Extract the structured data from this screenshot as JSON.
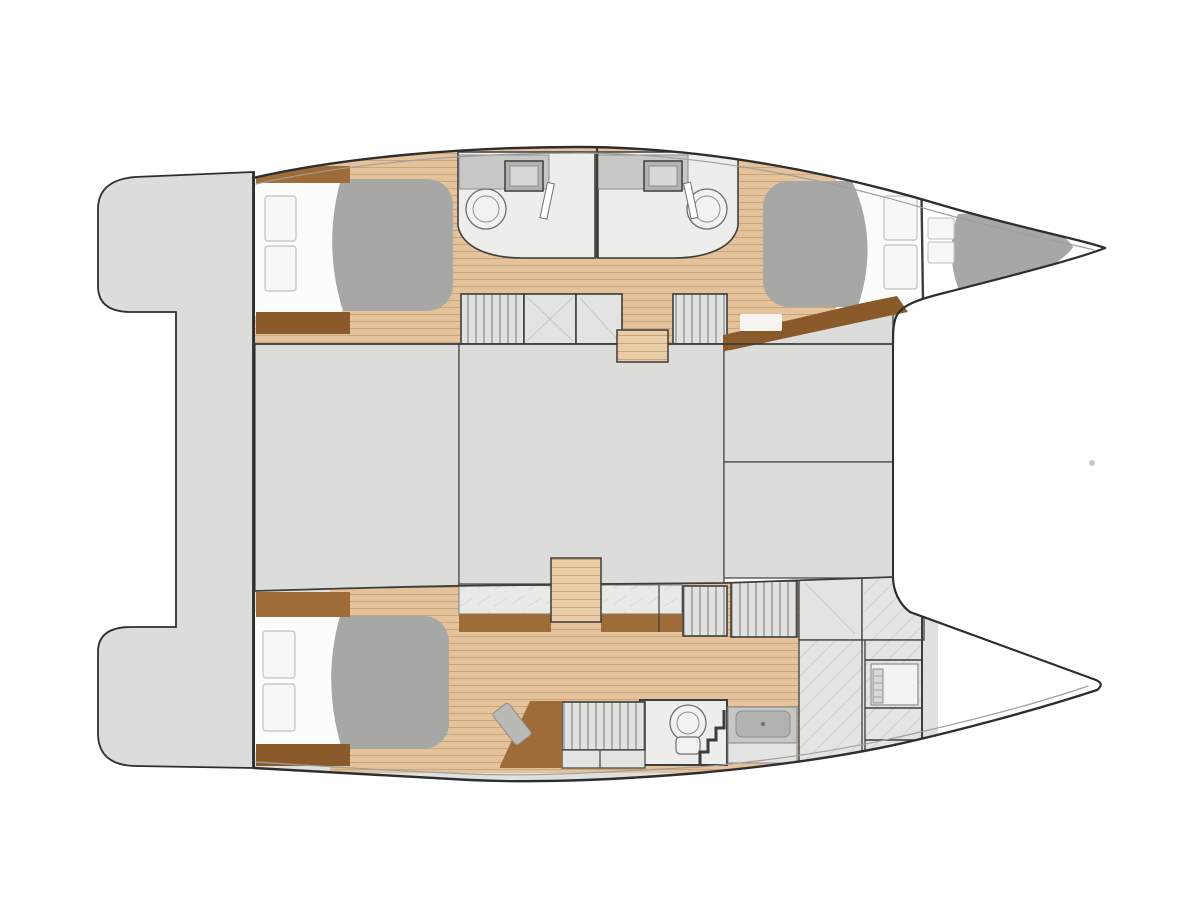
{
  "colors": {
    "background": "#ffffff",
    "outline": "#2e2e2e",
    "wall": "#3d3d3d",
    "rim": "#9f9f9f",
    "platform": "#dcdcdb",
    "hull": "#e0e0df",
    "bridge": "#dcdcdb",
    "bridge_line": "#565656",
    "wood": "#e4c29b",
    "wood_line": "#c9a57a",
    "steps": "#e9cda6",
    "brown": "#9e6c38",
    "brown_dark": "#8a5a2b",
    "bedding": "#fcfcfa",
    "pillow": "#f7f7f5",
    "pillow_line": "#c9c9c6",
    "mattress": "#a7a7a5",
    "bath_floor": "#ededeb",
    "counter": "#c7c7c5",
    "counter_edge": "#8d8d8b",
    "sink": "#b2b2b0",
    "sink_inner": "#d8d8d6",
    "fixture": "#f2f2f0",
    "fixture_line": "#6e6e6e",
    "marble": "#e9e9e6",
    "marble_line": "#d7d7d2",
    "locker": "#e2e2e0",
    "locker_line": "#8e8e8c",
    "locker_plain": "#e3e3e2",
    "compartment": "#e4e4e2",
    "compartment_line": "#d3d3d0",
    "faint": "#c6c6c3",
    "seat": "#f6f4f0",
    "stool": "#b9b9b7",
    "white": "#ffffff",
    "artifact_dot": "#c9c9cd"
  }
}
